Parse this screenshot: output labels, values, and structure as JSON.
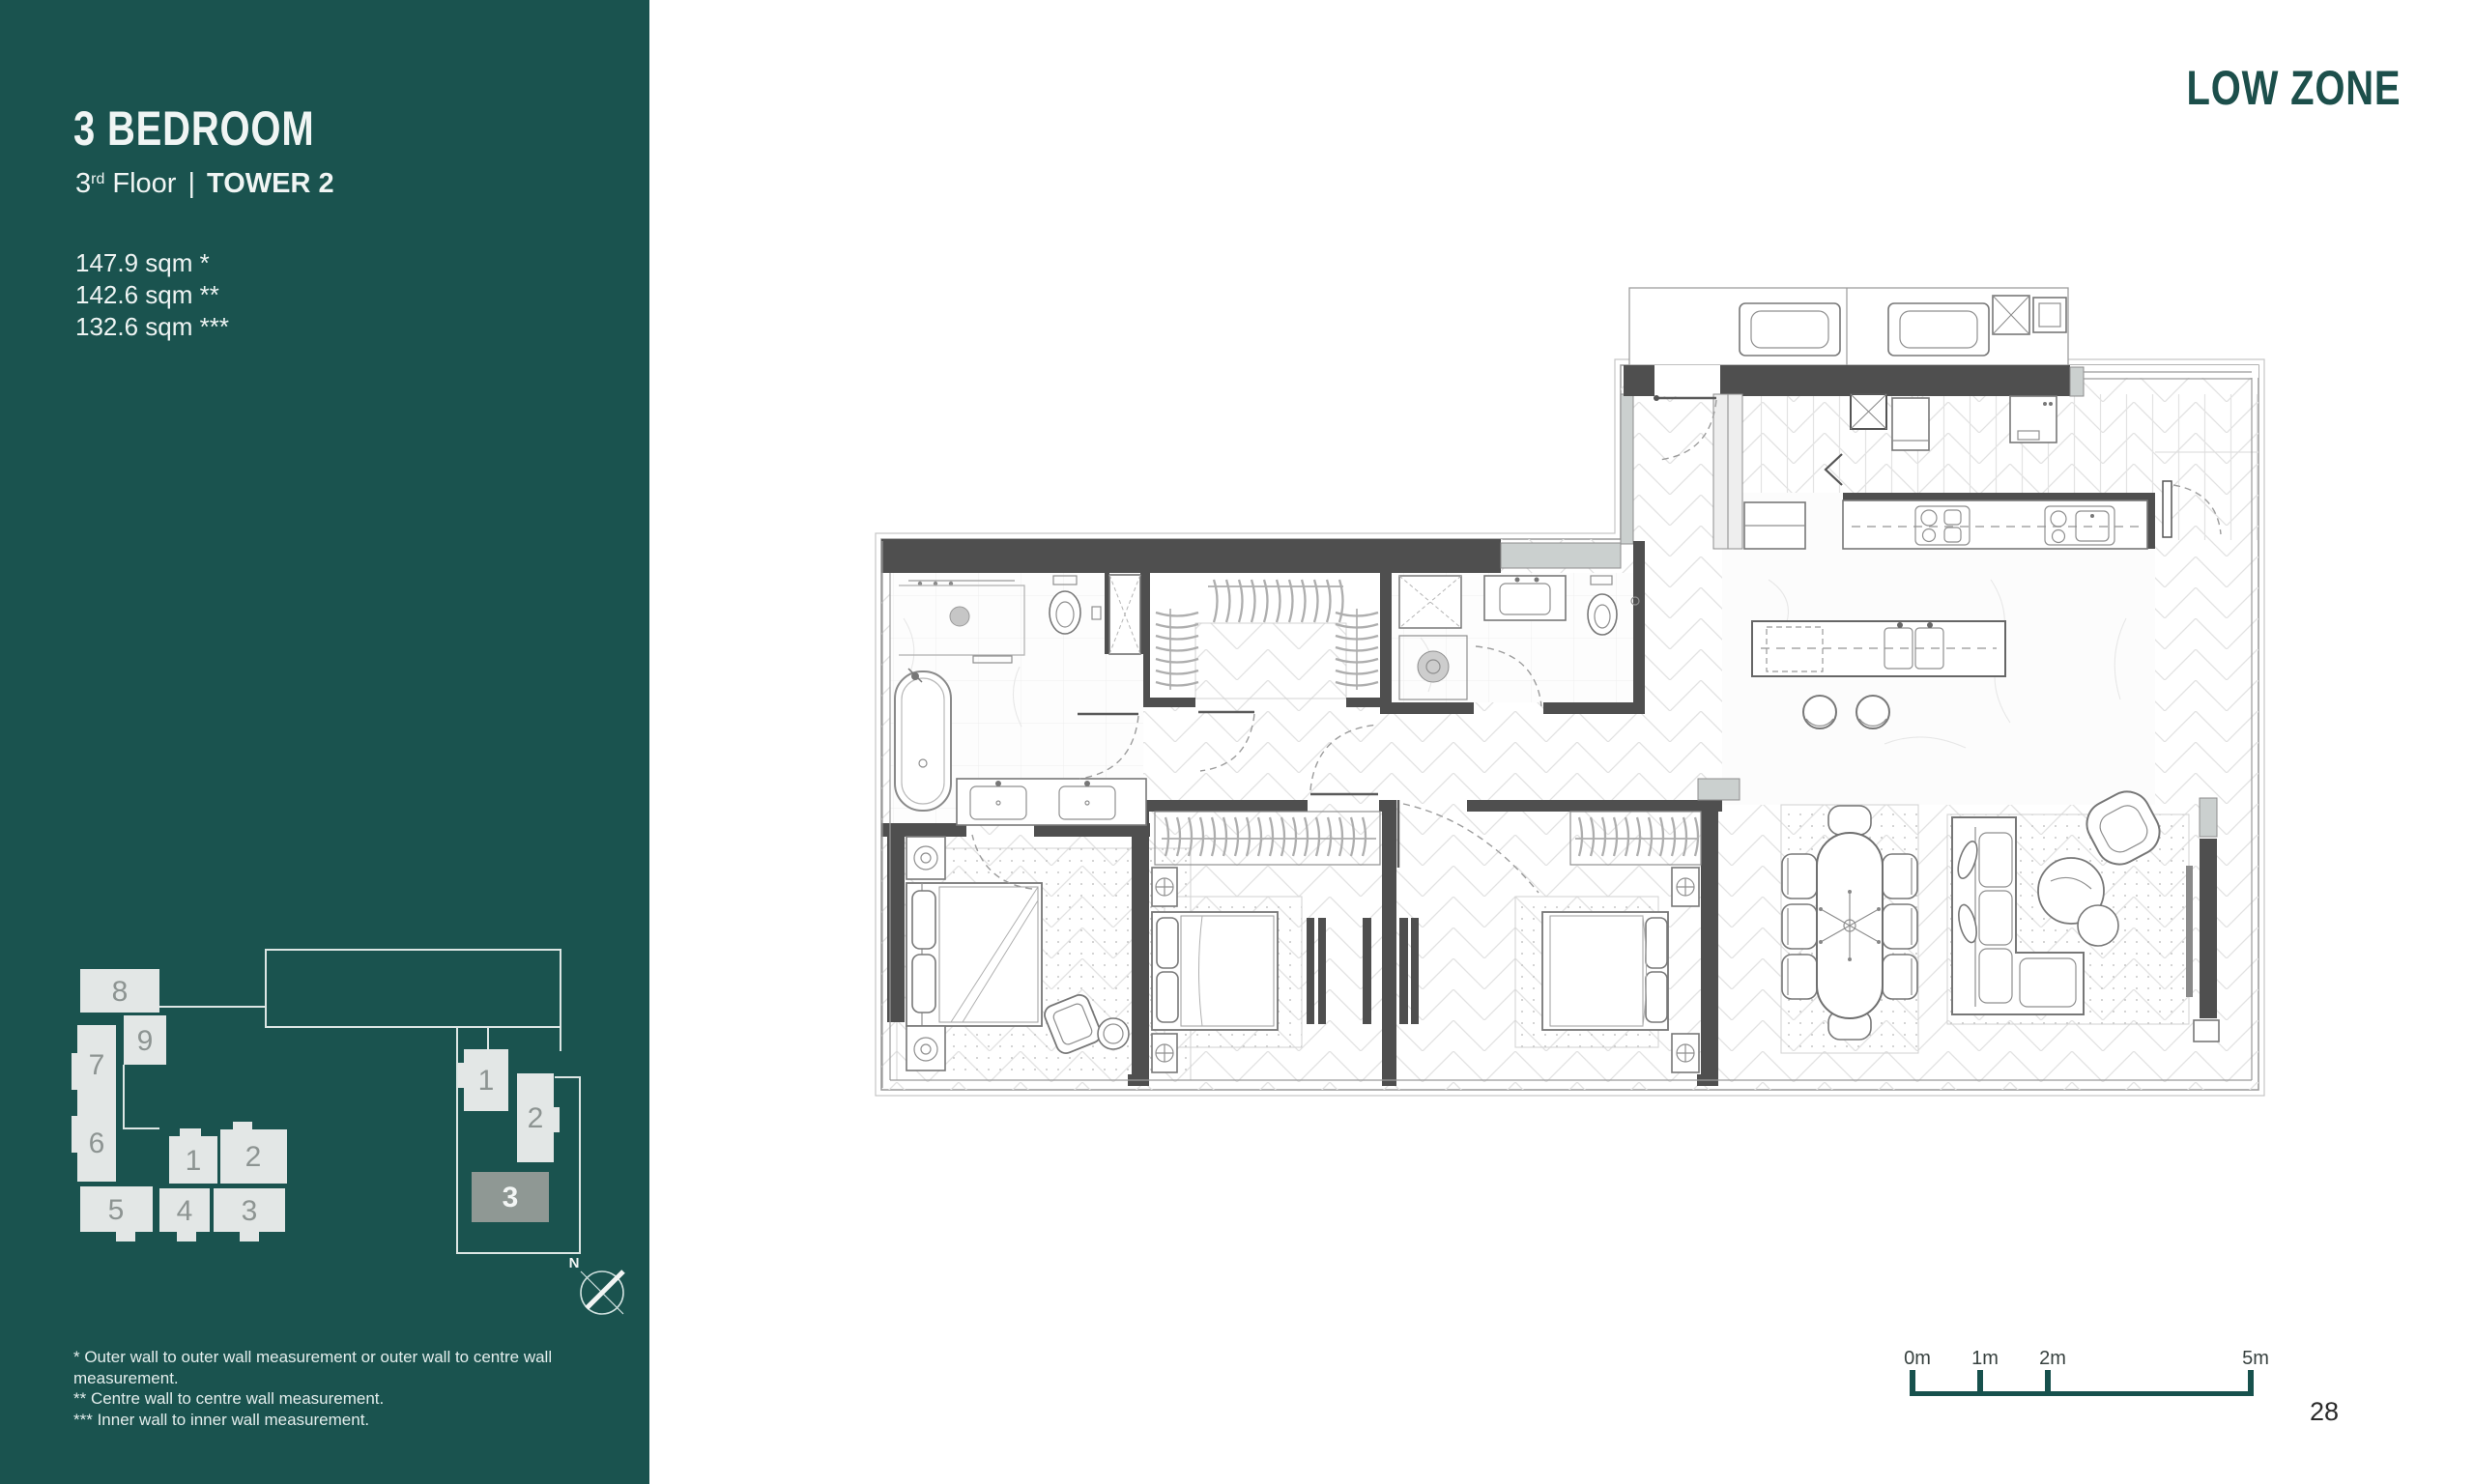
{
  "sidebar": {
    "background_color": "#1a534f",
    "title": "3 BEDROOM",
    "subtitle": {
      "floor_number": "3",
      "floor_ordinal": "rd",
      "floor_word": "Floor",
      "separator": "|",
      "tower": "TOWER 2"
    },
    "areas": [
      "147.9 sqm *",
      "142.6 sqm **",
      "132.6 sqm ***"
    ],
    "footnotes": [
      "* Outer wall to outer wall measurement or outer wall to centre wall measurement.",
      "** Centre wall to centre wall measurement.",
      "*** Inner wall to inner wall measurement."
    ],
    "keyplan": {
      "left_units": {
        "u8": "8",
        "u9": "9",
        "u7": "7",
        "u6": "6",
        "u5": "5",
        "u4": "4",
        "u3": "3",
        "u1": "1",
        "u2": "2"
      },
      "right_units": {
        "u1": "1",
        "u2": "2",
        "u3": "3"
      },
      "highlighted_unit": "3",
      "north_label": "N",
      "unit_box_color": "#e3e7e6",
      "highlight_color": "#8f9894",
      "number_color": "#8d9492"
    }
  },
  "main": {
    "zone_label": "LOW ZONE",
    "zone_color": "#1c4f4b",
    "scale_bar": {
      "labels": [
        "0m",
        "1m",
        "2m",
        "5m"
      ],
      "bar_color": "#17514d"
    },
    "page_number": "28"
  }
}
